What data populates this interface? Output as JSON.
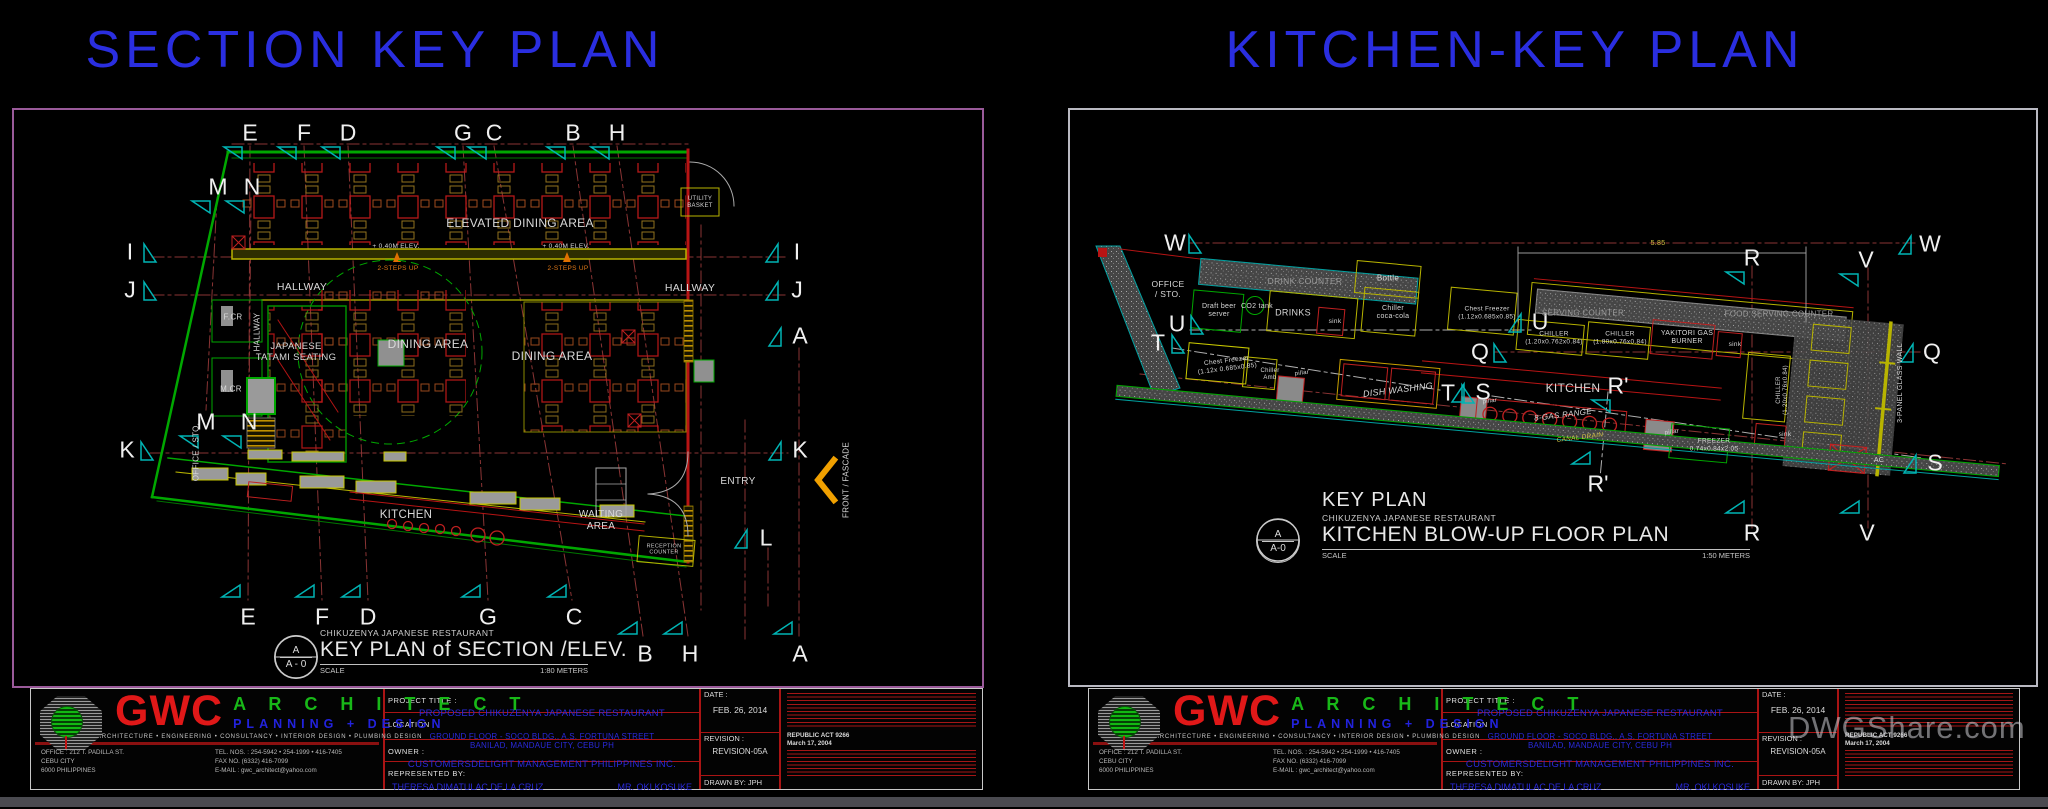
{
  "colors": {
    "title_blue": "#2a2ee0",
    "frame_purple": "#9a5a9a",
    "frame_gray": "#b9b9c2",
    "wall_green": "#00a800",
    "wall_red": "#b81414",
    "wall_yellow": "#b8b400",
    "marker_cyan": "#00b4b4",
    "grid_red": "#8a3434",
    "facade_arrow": "#f0a000"
  },
  "left_panel": {
    "title": "SECTION KEY PLAN",
    "caption": {
      "detail_letter": "A",
      "sheet": "A - 0",
      "project": "CHIKUZENYA JAPANESE RESTAURANT",
      "title": "KEY  PLAN of SECTION /ELEV.",
      "scale_label": "SCALE",
      "scale": "1:80 METERS"
    },
    "markers": [
      {
        "label": "E",
        "x": 250,
        "y": 133,
        "dir": "down"
      },
      {
        "label": "F",
        "x": 304,
        "y": 133,
        "dir": "down"
      },
      {
        "label": "D",
        "x": 348,
        "y": 133,
        "dir": "down"
      },
      {
        "label": "G",
        "x": 463,
        "y": 133,
        "dir": "down"
      },
      {
        "label": "C",
        "x": 494,
        "y": 133,
        "dir": "down"
      },
      {
        "label": "B",
        "x": 573,
        "y": 133,
        "dir": "down"
      },
      {
        "label": "H",
        "x": 617,
        "y": 133,
        "dir": "down"
      },
      {
        "label": "M",
        "x": 218,
        "y": 187,
        "dir": "down"
      },
      {
        "label": "N",
        "x": 252,
        "y": 187,
        "dir": "down"
      },
      {
        "label": "I",
        "x": 130,
        "y": 252,
        "dir": "right"
      },
      {
        "label": "J",
        "x": 130,
        "y": 290,
        "dir": "right"
      },
      {
        "label": "M",
        "x": 206,
        "y": 422,
        "dir": "down"
      },
      {
        "label": "N",
        "x": 249,
        "y": 422,
        "dir": "down"
      },
      {
        "label": "K",
        "x": 127,
        "y": 450,
        "dir": "right"
      },
      {
        "label": "I",
        "x": 797,
        "y": 252,
        "dir": "left"
      },
      {
        "label": "J",
        "x": 797,
        "y": 290,
        "dir": "left"
      },
      {
        "label": "A",
        "x": 800,
        "y": 336,
        "dir": "left"
      },
      {
        "label": "K",
        "x": 800,
        "y": 450,
        "dir": "left"
      },
      {
        "label": "L",
        "x": 766,
        "y": 538,
        "dir": "left"
      },
      {
        "label": "E",
        "x": 248,
        "y": 617,
        "dir": "up"
      },
      {
        "label": "F",
        "x": 322,
        "y": 617,
        "dir": "up"
      },
      {
        "label": "D",
        "x": 368,
        "y": 617,
        "dir": "up"
      },
      {
        "label": "G",
        "x": 488,
        "y": 617,
        "dir": "up"
      },
      {
        "label": "C",
        "x": 574,
        "y": 617,
        "dir": "up"
      },
      {
        "label": "B",
        "x": 645,
        "y": 654,
        "dir": "up"
      },
      {
        "label": "H",
        "x": 690,
        "y": 654,
        "dir": "up"
      },
      {
        "label": "A",
        "x": 800,
        "y": 654,
        "dir": "up"
      }
    ],
    "labels": [
      {
        "text": "ELEVATED DINING AREA",
        "x": 520,
        "y": 223,
        "size": 12
      },
      {
        "text": "HALLWAY",
        "x": 302,
        "y": 287,
        "size": 10.5
      },
      {
        "text": "HALLWAY",
        "x": 690,
        "y": 288,
        "size": 10.5
      },
      {
        "text": "DINING AREA",
        "x": 428,
        "y": 344,
        "size": 12
      },
      {
        "text": "DINING AREA",
        "x": 552,
        "y": 356,
        "size": 12
      },
      {
        "text": "JAPANESE\nTATAMI SEATING",
        "x": 296,
        "y": 352,
        "size": 9.5
      },
      {
        "text": "F.CR",
        "x": 233,
        "y": 317,
        "size": 8
      },
      {
        "text": "M.CR",
        "x": 231,
        "y": 389,
        "size": 8
      },
      {
        "text": "HALLWAY",
        "x": 257,
        "y": 332,
        "size": 8,
        "rot": -90
      },
      {
        "text": "OFFICE / STO.",
        "x": 196,
        "y": 452,
        "size": 8,
        "rot": -90
      },
      {
        "text": "KITCHEN",
        "x": 406,
        "y": 516,
        "size": 11.5
      },
      {
        "text": "WAITING\nAREA",
        "x": 601,
        "y": 521,
        "size": 10
      },
      {
        "text": "ENTRY",
        "x": 738,
        "y": 482,
        "size": 10
      },
      {
        "text": "UTILITY\nBASKET",
        "x": 700,
        "y": 203,
        "size": 6,
        "color": "#d8d8d8"
      },
      {
        "text": "FRONT / FASCADE",
        "x": 846,
        "y": 480,
        "size": 8,
        "rot": -90
      },
      {
        "text": "RECEPTION\nCOUNTER",
        "x": 664,
        "y": 550,
        "size": 5.5,
        "color": "#cccccc"
      },
      {
        "text": "+ 0.40M ELEV.",
        "x": 396,
        "y": 247,
        "size": 6.5
      },
      {
        "text": "+ 0.40M ELEV.",
        "x": 566,
        "y": 247,
        "size": 6.5
      },
      {
        "text": "2-STEPS UP",
        "x": 398,
        "y": 269,
        "size": 6.5,
        "color": "#e07818"
      },
      {
        "text": "2-STEPS UP",
        "x": 568,
        "y": 269,
        "size": 6.5,
        "color": "#e07818"
      }
    ]
  },
  "right_panel": {
    "title": "KITCHEN-KEY PLAN",
    "caption": {
      "detail_letter": "A",
      "sheet": "A-0",
      "heading": "KEY PLAN",
      "project": "CHIKUZENYA JAPANESE RESTAURANT",
      "title": "KITCHEN BLOW-UP FLOOR PLAN",
      "scale_label": "SCALE",
      "scale": "1:50 METERS"
    },
    "markers": [
      {
        "label": "W",
        "x": 1175,
        "y": 243,
        "dir": "right"
      },
      {
        "label": "U",
        "x": 1177,
        "y": 324,
        "dir": "right"
      },
      {
        "label": "T",
        "x": 1158,
        "y": 343,
        "dir": "right"
      },
      {
        "label": "Q",
        "x": 1480,
        "y": 352,
        "dir": "right"
      },
      {
        "label": "U",
        "x": 1540,
        "y": 322,
        "dir": "left"
      },
      {
        "label": "T",
        "x": 1448,
        "y": 393,
        "dir": "right"
      },
      {
        "label": "S",
        "x": 1483,
        "y": 392,
        "dir": "left"
      },
      {
        "label": "R",
        "x": 1752,
        "y": 258,
        "dir": "down"
      },
      {
        "label": "V",
        "x": 1866,
        "y": 260,
        "dir": "down"
      },
      {
        "label": "W",
        "x": 1930,
        "y": 244,
        "dir": "left"
      },
      {
        "label": "Q",
        "x": 1932,
        "y": 352,
        "dir": "left"
      },
      {
        "label": "S",
        "x": 1935,
        "y": 463,
        "dir": "left"
      },
      {
        "label": "R'",
        "x": 1618,
        "y": 386,
        "dir": "down"
      },
      {
        "label": "R'",
        "x": 1598,
        "y": 484,
        "dir": "up"
      },
      {
        "label": "R",
        "x": 1752,
        "y": 533,
        "dir": "up"
      },
      {
        "label": "V",
        "x": 1867,
        "y": 533,
        "dir": "up"
      }
    ],
    "labels": [
      {
        "text": "OFFICE\n/ STO.",
        "x": 1168,
        "y": 289,
        "size": 8.5
      },
      {
        "text": "DRINK COUNTER",
        "x": 1305,
        "y": 281,
        "size": 8.5,
        "color": "#9a9a9a"
      },
      {
        "text": "Bottle",
        "x": 1388,
        "y": 278,
        "size": 8
      },
      {
        "text": "Draft beer\nserver",
        "x": 1219,
        "y": 311,
        "size": 7
      },
      {
        "text": "CO2 tank",
        "x": 1257,
        "y": 307,
        "size": 7
      },
      {
        "text": "DRINKS",
        "x": 1293,
        "y": 313,
        "size": 9
      },
      {
        "text": "sink",
        "x": 1335,
        "y": 322,
        "size": 6.5
      },
      {
        "text": "Chiller\ncoca-cola",
        "x": 1393,
        "y": 313,
        "size": 7
      },
      {
        "text": "Chest Freezer\n(1.12x0.685x0.85)",
        "x": 1487,
        "y": 313,
        "size": 6.5
      },
      {
        "text": "SERVING COUNTER",
        "x": 1583,
        "y": 313,
        "size": 8,
        "color": "#9a9a9a"
      },
      {
        "text": "FOOD SERVING COUNTER",
        "x": 1779,
        "y": 314,
        "size": 8,
        "color": "#9a9a9a"
      },
      {
        "text": "CHILLER\n(1.20x0.762x0.84)",
        "x": 1554,
        "y": 338,
        "size": 6.5
      },
      {
        "text": "CHILLER\n(1.80x0.76x0.84)",
        "x": 1620,
        "y": 338,
        "size": 6.5
      },
      {
        "text": "YAKITORI GAS\nBURNER",
        "x": 1687,
        "y": 338,
        "size": 7
      },
      {
        "text": "sink",
        "x": 1735,
        "y": 345,
        "size": 6.5
      },
      {
        "text": "Chest Freezer\n(1.12x 0.685x0.85)",
        "x": 1227,
        "y": 365,
        "size": 6.5,
        "rot": -7
      },
      {
        "text": "Chiller\nAmb",
        "x": 1270,
        "y": 375,
        "size": 6
      },
      {
        "text": "pillar",
        "x": 1302,
        "y": 374,
        "size": 6,
        "rot": -7
      },
      {
        "text": "DISH WASHING",
        "x": 1398,
        "y": 390,
        "size": 9,
        "rot": -7,
        "style": "italic"
      },
      {
        "text": "KITCHEN",
        "x": 1573,
        "y": 388,
        "size": 12
      },
      {
        "text": "8-GAS RANGE",
        "x": 1563,
        "y": 415,
        "size": 8,
        "rot": -7,
        "style": "italic"
      },
      {
        "text": "CANAL DRAIN",
        "x": 1580,
        "y": 438,
        "size": 6.5,
        "rot": -7,
        "style": "italic",
        "color": "#d0c040"
      },
      {
        "text": "pillar",
        "x": 1490,
        "y": 402,
        "size": 6,
        "rot": -7
      },
      {
        "text": "pillar",
        "x": 1672,
        "y": 433,
        "size": 6,
        "rot": -7
      },
      {
        "text": "FREEZER\n0.74x0.84x2.05",
        "x": 1714,
        "y": 445,
        "size": 6.5
      },
      {
        "text": "sink",
        "x": 1785,
        "y": 435,
        "size": 6.5
      },
      {
        "text": "CHILLER\n(1.20x0.76x0.84)",
        "x": 1783,
        "y": 390,
        "size": 6,
        "rot": -90
      },
      {
        "text": "3-PANEL GLASS WALL",
        "x": 1901,
        "y": 383,
        "size": 7,
        "rot": -90
      },
      {
        "text": "AC",
        "x": 1879,
        "y": 461,
        "size": 7
      },
      {
        "text": "5.85",
        "x": 1658,
        "y": 244,
        "size": 7,
        "color": "#d0c040"
      }
    ]
  },
  "title_block": {
    "brand": "GWC",
    "brand_word": "A R C H I T E C T",
    "brand_sub": "PLANNING   +   DESIGN",
    "services": "ARCHITECTURE      •      ENGINEERING      •      CONSULTANCY      •      INTERIOR DESIGN      •      PLUMBING DESIGN",
    "office_lines": [
      "OFFICE : 212 T. PADILLA ST.",
      "CEBU CITY",
      "6000 PHILIPPINES"
    ],
    "contact_lines": [
      "TEL. NOS. : 254-5942 • 254-1999 • 416-7405",
      "FAX NO. (6332) 416-7099",
      "E-MAIL : gwc_architect@yahoo.com"
    ],
    "fields": {
      "project_title_label": "PROJECT TITLE :",
      "project_title": "PROPOSED CHIKUZENYA  JAPANESE RESTAURANT",
      "location_label": "LOCATION :",
      "location_line1": "GROUND FLOOR - SOCO BLDG.,  A.S. FORTUNA STREET",
      "location_line2": "BANILAD, MANDAUE CITY,  CEBU PH",
      "owner_label": "OWNER :",
      "owner": "CUSTOMERSDELIGHT  MANAGEMENT PHILIPPINES INC.",
      "represented_label": "REPRESENTED  BY:",
      "represented_1": "THERESA DIMATULAC  DE LA CRUZ",
      "represented_2": "MR. OKI  KOSUKE",
      "date_label": "DATE :",
      "date": "FEB. 26, 2014",
      "revision_label": "REVISION :",
      "revision": "REVISION-05A",
      "drawn_by": "DRAWN BY: JPH"
    },
    "notes": {
      "act": "REPUBLIC  ACT 9266",
      "act_date": "March 17, 2004"
    }
  },
  "watermark": "DWGShare.com"
}
